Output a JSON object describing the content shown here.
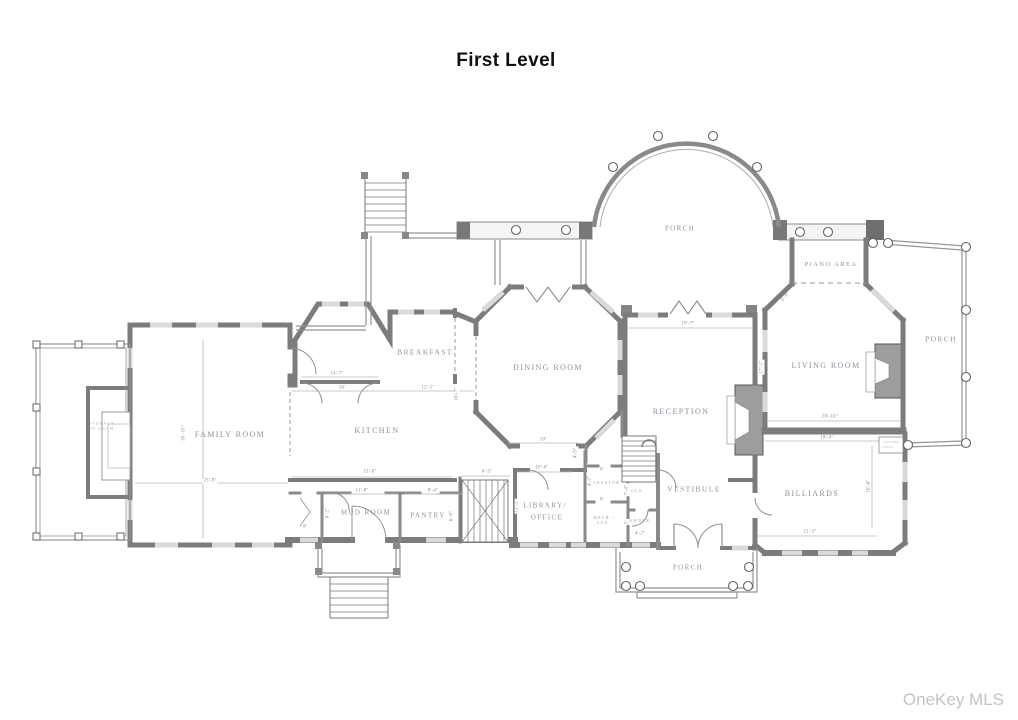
{
  "title": "First Level",
  "watermark": "OneKey MLS",
  "colors": {
    "background": "#ffffff",
    "wall": "#7c7c7c",
    "room_label": "#8f929c",
    "dimension_label": "#8a8a8a",
    "title_text": "#101010",
    "watermark_text": "#c4c4c4"
  },
  "room_labels": [
    {
      "n": "label-family-room",
      "t": "FAMILY ROOM",
      "x": 230,
      "y": 435,
      "fs": 8
    },
    {
      "n": "label-kitchen",
      "t": "KITCHEN",
      "x": 377,
      "y": 431,
      "fs": 8
    },
    {
      "n": "label-breakfast",
      "t": "BREAKFAST",
      "x": 425,
      "y": 352,
      "fs": 7.5
    },
    {
      "n": "label-dining-room",
      "t": "DINING ROOM",
      "x": 548,
      "y": 368,
      "fs": 8
    },
    {
      "n": "label-reception",
      "t": "RECEPTION",
      "x": 681,
      "y": 412,
      "fs": 8
    },
    {
      "n": "label-vestibule",
      "t": "VESTIBULE",
      "x": 694,
      "y": 489,
      "fs": 7.5
    },
    {
      "n": "label-living-room",
      "t": "LIVING ROOM",
      "x": 826,
      "y": 366,
      "fs": 8
    },
    {
      "n": "label-piano-area",
      "t": "PIANO AREA",
      "x": 831,
      "y": 265,
      "fs": 6.5
    },
    {
      "n": "label-porch-top",
      "t": "PORCH",
      "x": 680,
      "y": 229,
      "fs": 7
    },
    {
      "n": "label-porch-right",
      "t": "PORCH",
      "x": 941,
      "y": 339,
      "fs": 7.5
    },
    {
      "n": "label-porch-bottom",
      "t": "PORCH",
      "x": 688,
      "y": 568,
      "fs": 7
    },
    {
      "n": "label-billiards",
      "t": "BILLIARDS",
      "x": 812,
      "y": 494,
      "fs": 8
    },
    {
      "n": "label-mud-room",
      "t": "MUD ROOM",
      "x": 366,
      "y": 513,
      "fs": 7
    },
    {
      "n": "label-pantry",
      "t": "PANTRY",
      "x": 428,
      "y": 516,
      "fs": 7
    },
    {
      "n": "label-library-line1",
      "t": "LIBRARY/",
      "x": 545,
      "y": 506,
      "fs": 7
    },
    {
      "n": "label-library-line2",
      "t": "OFFICE",
      "x": 547,
      "y": 518,
      "fs": 7
    },
    {
      "n": "label-elevator",
      "t": "ELEVATOR",
      "x": 605,
      "y": 484,
      "fs": 3.8
    },
    {
      "n": "label-clo",
      "t": "CLO",
      "x": 637,
      "y": 492,
      "fs": 3.8
    },
    {
      "n": "label-mech-line1",
      "t": "MECH./",
      "x": 604,
      "y": 519,
      "fs": 3.8
    },
    {
      "n": "label-mech-line2",
      "t": "CLO.",
      "x": 604,
      "y": 524,
      "fs": 3.8
    },
    {
      "n": "label-powder",
      "t": "POWDER",
      "x": 638,
      "y": 522,
      "fs": 3.8
    },
    {
      "n": "label-storage-line1",
      "t": "STORAGE",
      "x": 102,
      "y": 424,
      "fs": 3.5
    },
    {
      "n": "label-storage-line2",
      "t": "IN ROOM",
      "x": 102,
      "y": 429,
      "fs": 3.5
    }
  ],
  "dimension_labels": [
    {
      "t": "30'-10\"",
      "x": 184,
      "y": 433,
      "r": -90
    },
    {
      "t": "23'-9\"",
      "x": 210,
      "y": 481
    },
    {
      "t": "14'-7\"",
      "x": 337,
      "y": 374
    },
    {
      "t": "16'",
      "x": 342,
      "y": 388
    },
    {
      "t": "12'-1\"",
      "x": 428,
      "y": 388
    },
    {
      "t": "16'-7\"",
      "x": 457,
      "y": 394,
      "r": -90
    },
    {
      "t": "21'-8\"",
      "x": 370,
      "y": 472
    },
    {
      "t": "6'-3\"",
      "x": 487,
      "y": 472
    },
    {
      "t": "11'-8\"",
      "x": 362,
      "y": 491
    },
    {
      "t": "8'-4\"",
      "x": 433,
      "y": 491
    },
    {
      "t": "6'-2\"",
      "x": 328,
      "y": 513,
      "r": -90
    },
    {
      "t": "8'",
      "x": 305,
      "y": 527
    },
    {
      "t": "6'-8\"",
      "x": 452,
      "y": 516,
      "r": -90
    },
    {
      "t": "10'",
      "x": 543,
      "y": 440
    },
    {
      "t": "4'-9\"",
      "x": 576,
      "y": 453,
      "r": -90
    },
    {
      "t": "10'-6\"",
      "x": 542,
      "y": 468
    },
    {
      "t": "12'-1\"",
      "x": 517,
      "y": 506,
      "r": -90
    },
    {
      "t": "8'",
      "x": 602,
      "y": 470
    },
    {
      "t": "4'-2\"",
      "x": 590,
      "y": 481,
      "r": -90
    },
    {
      "t": "8'",
      "x": 602,
      "y": 500
    },
    {
      "t": "7'-4\"",
      "x": 627,
      "y": 490,
      "r": -90
    },
    {
      "t": "5'",
      "x": 627,
      "y": 522,
      "r": -90
    },
    {
      "t": "4'-2\"",
      "x": 640,
      "y": 534
    },
    {
      "t": "19'-7\"",
      "x": 688,
      "y": 324
    },
    {
      "t": "17'-1\"",
      "x": 762,
      "y": 367,
      "r": -90
    },
    {
      "t": "6'-9\"",
      "x": 786,
      "y": 297,
      "r": -48
    },
    {
      "t": "20'-10\"",
      "x": 830,
      "y": 417
    },
    {
      "t": "18'-4\"",
      "x": 827,
      "y": 438
    },
    {
      "t": "16'-6\"",
      "x": 869,
      "y": 486,
      "r": -90
    },
    {
      "t": "21'-3\"",
      "x": 810,
      "y": 532
    }
  ]
}
